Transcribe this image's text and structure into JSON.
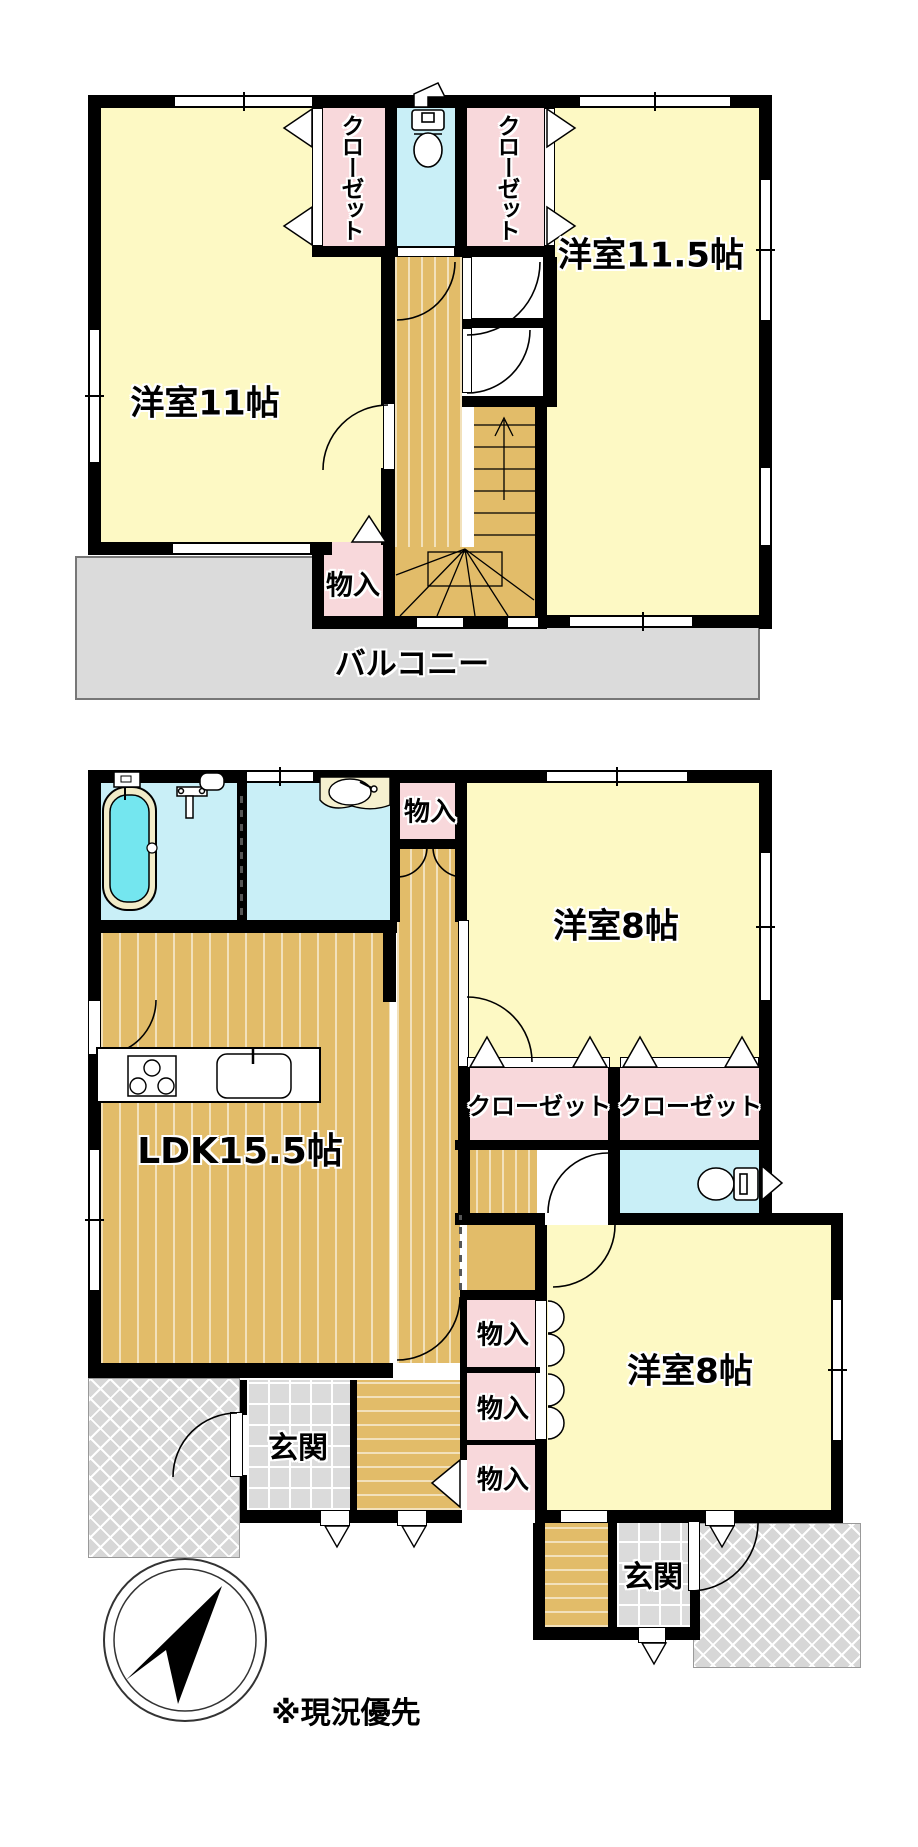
{
  "floor2": {
    "rooms": {
      "room11": {
        "label": "洋室11帖"
      },
      "room11_5": {
        "label": "洋室11.5帖"
      },
      "closet_left": {
        "label": "クローゼット"
      },
      "closet_right": {
        "label": "クローゼット"
      },
      "storage": {
        "label": "物入"
      },
      "balcony": {
        "label": "バルコニー"
      }
    }
  },
  "floor1": {
    "rooms": {
      "storage_top": {
        "label": "物入"
      },
      "room8_upper": {
        "label": "洋室8帖"
      },
      "closet_1": {
        "label": "クローゼット"
      },
      "closet_2": {
        "label": "クローゼット"
      },
      "ldk": {
        "label": "LDK15.5帖"
      },
      "storage_1": {
        "label": "物入"
      },
      "storage_2": {
        "label": "物入"
      },
      "storage_3": {
        "label": "物入"
      },
      "room8_lower": {
        "label": "洋室8帖"
      },
      "genkan_main": {
        "label": "玄関"
      },
      "genkan_second": {
        "label": "玄関"
      }
    }
  },
  "annotations": {
    "note": "※現況優先"
  },
  "colors": {
    "room_yellow": "#FDF9C4",
    "closet_pink": "#F8D8DB",
    "water_cyan": "#C9EFF7",
    "tub_cyan": "#74E6EF",
    "floor_tan": "#E2BC69",
    "balcony_gray": "#DBDBDB",
    "wall_black": "#000000"
  }
}
